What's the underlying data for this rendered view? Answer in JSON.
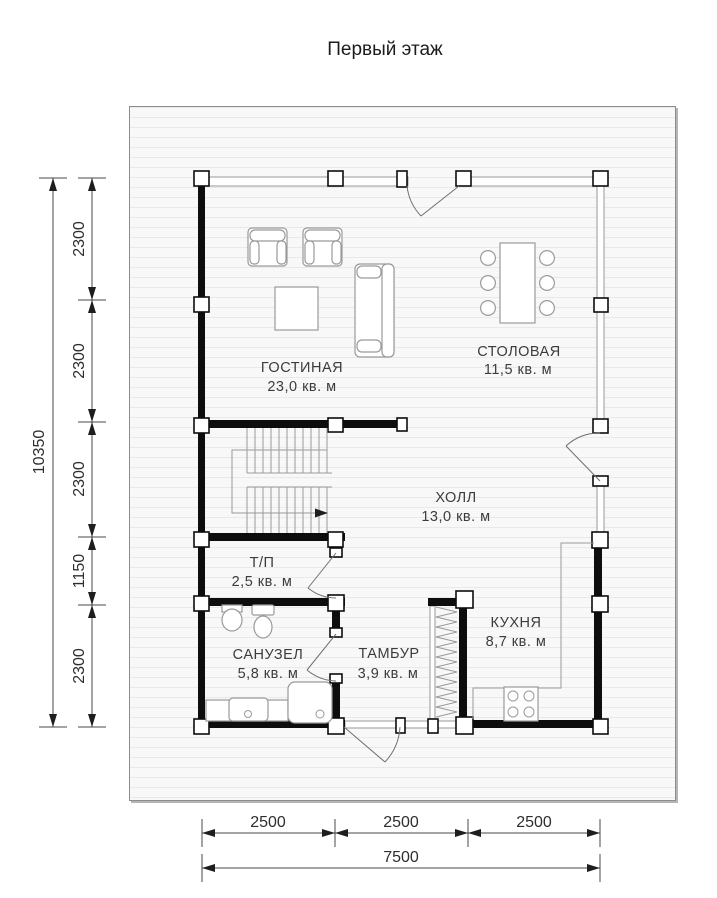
{
  "title": "Первый этаж",
  "rooms": {
    "living": {
      "name": "ГОСТИНАЯ",
      "area": "23,0 кв. м"
    },
    "dining": {
      "name": "СТОЛОВАЯ",
      "area": "11,5 кв. м"
    },
    "hall": {
      "name": "ХОЛЛ",
      "area": "13,0 кв. м"
    },
    "tp": {
      "name": "Т/П",
      "area": "2,5 кв. м"
    },
    "bathroom": {
      "name": "САНУЗЕЛ",
      "area": "5,8 кв. м"
    },
    "vestibule": {
      "name": "ТАМБУР",
      "area": "3,9 кв. м"
    },
    "kitchen": {
      "name": "КУХНЯ",
      "area": "8,7 кв. м"
    }
  },
  "dimensions": {
    "vertical_total": "10350",
    "vertical_segments": [
      "2300",
      "2300",
      "2300",
      "1150",
      "2300"
    ],
    "horizontal_total": "7500",
    "horizontal_segments": [
      "2500",
      "2500",
      "2500"
    ]
  },
  "colors": {
    "wall": "#0d0d0d",
    "furniture_line": "#9a9a9a",
    "site_fill": "#f8f8f8",
    "site_line": "#e9e9e9"
  }
}
